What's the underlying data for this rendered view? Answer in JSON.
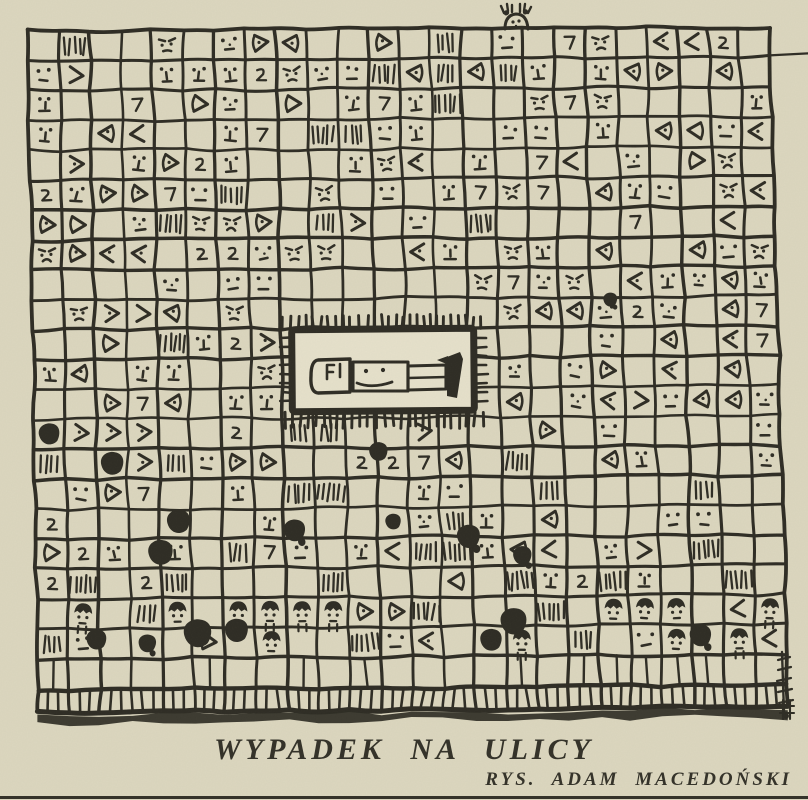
{
  "artwork": {
    "title": "WYPADEK NA ULICY",
    "credit": "RYS. ADAM MACEDOŃSKI"
  },
  "drawing": {
    "ink_color": "#2e2c24",
    "paper_color": "#dcd7bf",
    "panel_color": "#e6e1cb",
    "caption_color": "#35332a",
    "grid_cols": 24,
    "grid_rows": 21
  }
}
